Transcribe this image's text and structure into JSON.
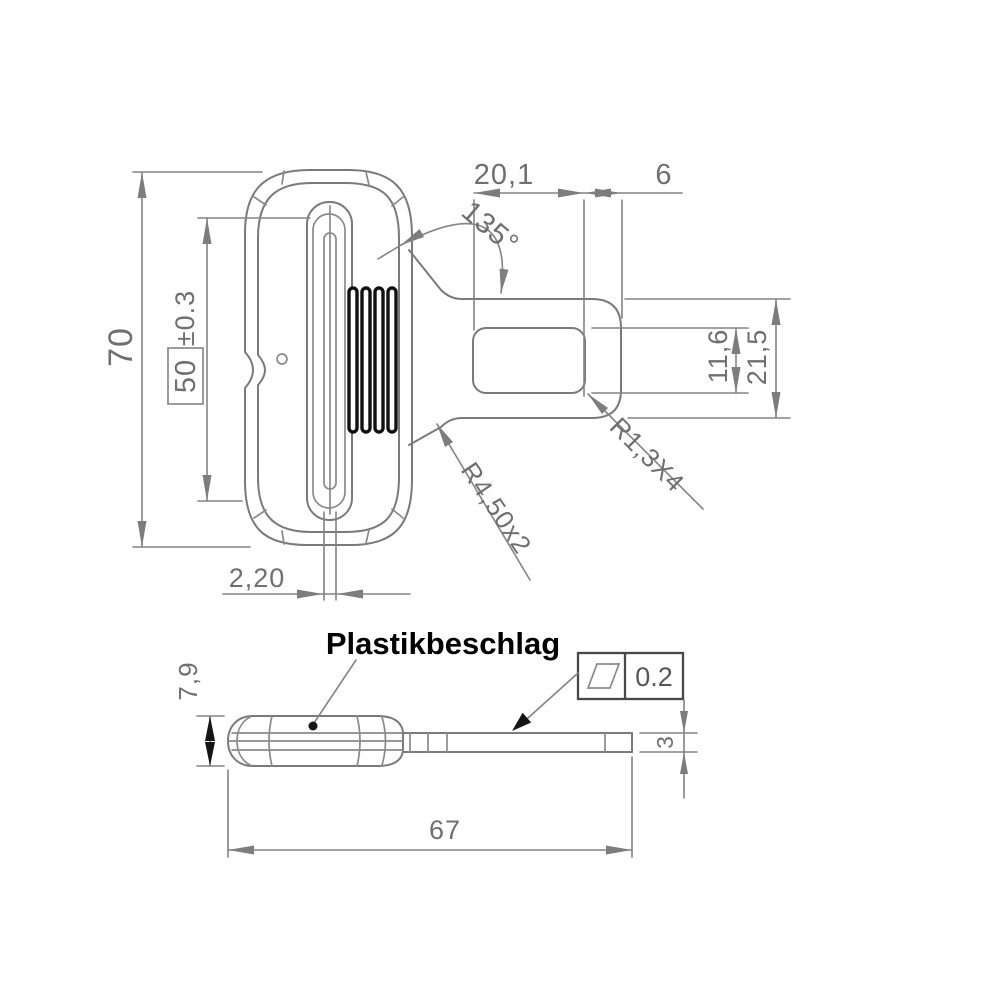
{
  "part_label": "Plastikbeschlag",
  "top_view": {
    "overall_height": "70",
    "slot_length": "50",
    "slot_length_tolerance": "±0.3",
    "web_slot_width": "2,20",
    "tongue_slot_length": "20,1",
    "tongue_tip_length": "6",
    "neck_angle": "135°",
    "tongue_slot_height": "11,6",
    "tongue_height": "21,5",
    "slot_corner_radius": "R1,3X4",
    "neck_fillet_radius": "R4,50x2"
  },
  "side_view": {
    "body_thickness": "7,9",
    "tongue_thickness": "3",
    "overall_length": "67",
    "flatness_symbol": "flatness-parallelogram",
    "flatness_tolerance": "0.2"
  },
  "colors": {
    "background": "#ffffff",
    "line_gray": "#7a7a7a",
    "dim_text_gray": "#6f6f6f",
    "black_ink": "#111111"
  }
}
